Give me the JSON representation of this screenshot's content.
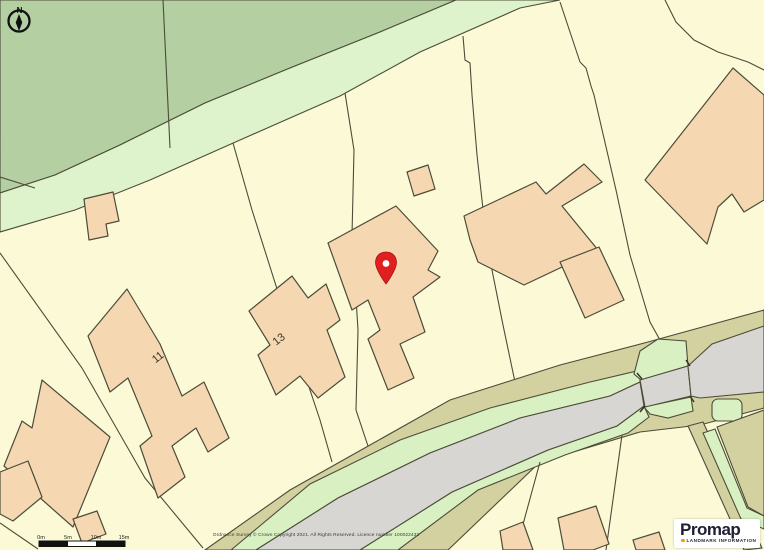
{
  "app": {
    "name": "Promap map view"
  },
  "map": {
    "north_label": "N",
    "house_labels": [
      {
        "text": "11",
        "x": 160,
        "y": 360,
        "rotation": -38
      },
      {
        "text": "13",
        "x": 281,
        "y": 342,
        "rotation": -38
      }
    ],
    "pin": {
      "x": 386,
      "y": 268,
      "color": "#e02020"
    },
    "scale_bar": {
      "labels": [
        "0m",
        "5m",
        "10m",
        "15m"
      ]
    },
    "copyright": "Ordnance Survey © Crown Copyright 2021. All Rights Reserved. Licence number 100022432",
    "logo": {
      "brand": "Promap",
      "tagline": "LANDMARK INFORMATION"
    },
    "colors": {
      "parcel_cream": "#fcfad6",
      "field_green": "#b4cfa2",
      "lane_green": "#def3cc",
      "verge_khaki": "#d4d1a0",
      "grass_strip": "#d9f0c2",
      "road_gray": "#d7d6d2",
      "building_fill": "#f5d8b2",
      "outline": "#4c4c38",
      "pin_red": "#e02020",
      "logo_navy": "#1e1e34",
      "logo_orange": "#f59b00"
    }
  }
}
